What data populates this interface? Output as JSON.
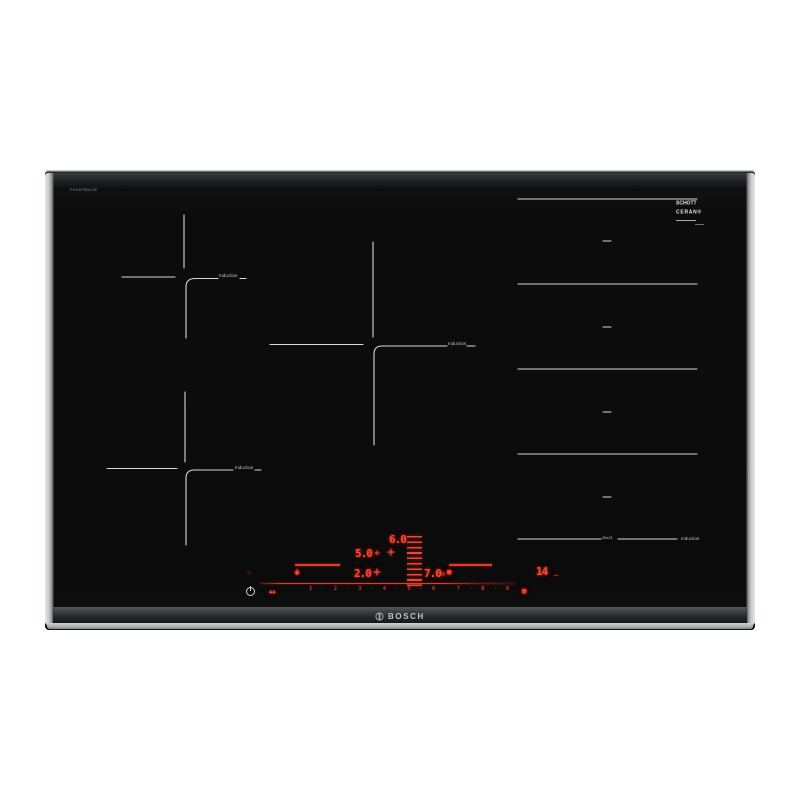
{
  "hob": {
    "model_text": "PXV875DC1E",
    "brand_name": "BOSCH",
    "schott_logo": {
      "line1": "SCHOTT",
      "line2": "CERAN®"
    },
    "zone_labels": {
      "induction": "Induction",
      "flex_size": "45x21"
    },
    "control_panel": {
      "power_levels": {
        "top": "6.0",
        "middle": "5.0",
        "lower": "2.0",
        "right": "7.0"
      },
      "timer_minutes": "14",
      "cross_glyph": "+",
      "slider_numbers": [
        "1",
        "2",
        "3",
        "4",
        "5",
        "6",
        "7",
        "8",
        "9"
      ],
      "slider_separator": "·",
      "icons": {
        "pan": "▭",
        "sensor_drop": "◊",
        "chef": "▲",
        "bridge_small": "▪",
        "bridge_full": "▣",
        "bridge_open": "◻",
        "wave": "~",
        "dot": "•",
        "clock_mini": "⊙",
        "timer_unit_dash": "–",
        "pan_detect_dim": "⊙",
        "move_arrows": "▲▲",
        "boost": "▤",
        "timer_clock": "◔",
        "alarm_clock": "⊙"
      }
    },
    "colors": {
      "background": "#ffffff",
      "glass": "#0c0c0c",
      "zone_line": "#d9d9d9",
      "led": "#ff4636",
      "led_dim": "#b03224"
    }
  }
}
